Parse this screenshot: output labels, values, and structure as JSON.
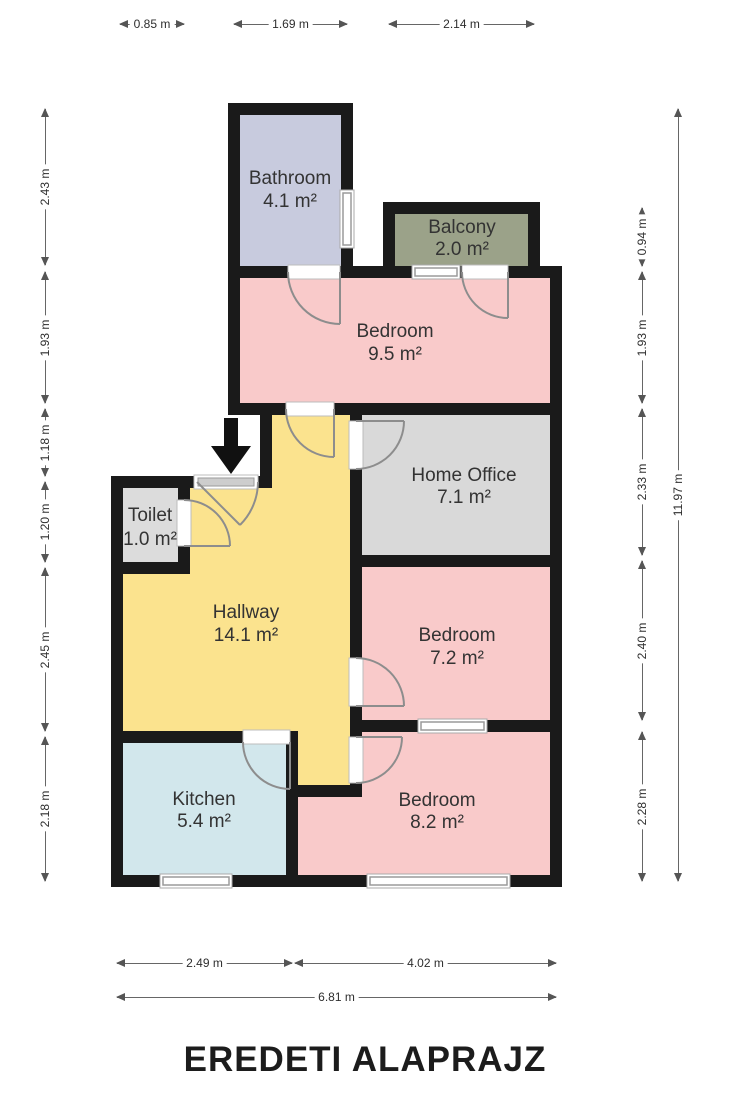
{
  "title": "EREDETI ALAPRAJZ",
  "rooms": [
    {
      "id": "bathroom",
      "name": "Bathroom",
      "area": "4.1 m²",
      "color": "#c8cbde"
    },
    {
      "id": "balcony",
      "name": "Balcony",
      "area": "2.0 m²",
      "color": "#9ba289"
    },
    {
      "id": "bedroom-1",
      "name": "Bedroom",
      "area": "9.5 m²",
      "color": "#f9caca"
    },
    {
      "id": "home-office",
      "name": "Home Office",
      "area": "7.1 m²",
      "color": "#d9d9d9"
    },
    {
      "id": "toilet",
      "name": "Toilet",
      "area": "1.0 m²",
      "color": "#dcdcdc"
    },
    {
      "id": "hallway",
      "name": "Hallway",
      "area": "14.1 m²",
      "color": "#fbe38e"
    },
    {
      "id": "bedroom-2",
      "name": "Bedroom",
      "area": "7.2 m²",
      "color": "#f9caca"
    },
    {
      "id": "kitchen",
      "name": "Kitchen",
      "area": "5.4 m²",
      "color": "#d2e7ec"
    },
    {
      "id": "bedroom-3",
      "name": "Bedroom",
      "area": "8.2 m²",
      "color": "#f9caca"
    }
  ],
  "dimensions": {
    "top": [
      "0.85 m",
      "1.69 m",
      "2.14 m"
    ],
    "left": [
      "2.43 m",
      "1.93 m",
      "1.18 m",
      "1.20 m",
      "2.45 m",
      "2.18 m"
    ],
    "right": [
      "0.94 m",
      "1.93 m",
      "2.33 m",
      "2.40 m",
      "2.28 m"
    ],
    "right_total": "11.97 m",
    "bottom": [
      "2.49 m",
      "4.02 m"
    ],
    "bottom_total": "6.81 m"
  },
  "colors": {
    "wall": "#1a1a1a",
    "door_arc": "#8d8d8d",
    "window_frame": "#9a9a9a",
    "dimension_line": "#555555",
    "title_text": "#1c1c1c"
  }
}
